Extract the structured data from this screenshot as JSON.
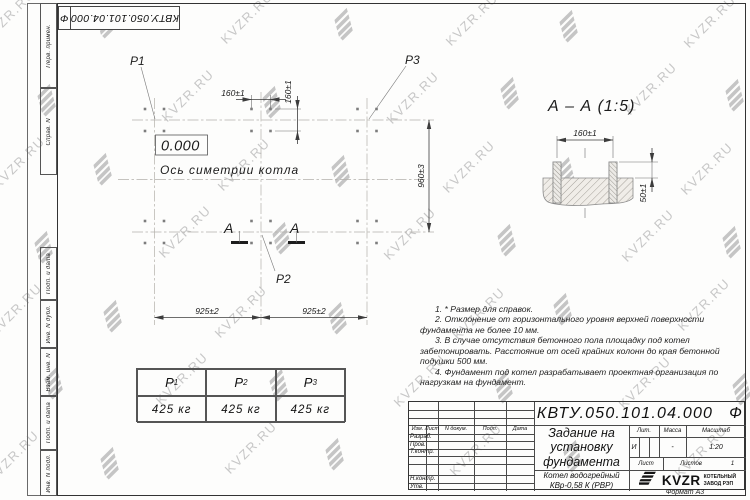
{
  "colors": {
    "ink": "#1c1c1c",
    "light_line": "#b3b0ab",
    "watermark": "#c7c7c7"
  },
  "watermark": {
    "text": "KVZR.RU"
  },
  "side_column": {
    "labels": [
      "Перв. примен.",
      "Справ. N",
      "Подп. и дата",
      "Инв. N дубл.",
      "Взам. инв. N",
      "Подп. и дата",
      "Инв. N подл."
    ]
  },
  "plan": {
    "markers": {
      "p1": "P1",
      "p2": "P2",
      "p3": "P3"
    },
    "elevation": "0.000",
    "axis_label": "Ось симетрии котла",
    "section_letter": "А",
    "dims": {
      "col_left": "925±2",
      "col_right": "925±2",
      "row": "960±3",
      "bolt_h": "160±1",
      "bolt_v": "160±1"
    }
  },
  "section": {
    "title": "А – А (1:5)",
    "dims": {
      "spacing": "160±1",
      "height": "50±1"
    }
  },
  "loads_table": {
    "headers": [
      {
        "base": "P",
        "sub": "1"
      },
      {
        "base": "P",
        "sub": "2"
      },
      {
        "base": "P",
        "sub": "3"
      }
    ],
    "values": [
      "425 кг",
      "425 кг",
      "425 кг"
    ]
  },
  "notes": {
    "items": [
      "1. * Размер для справок.",
      "2. Отклонение от горизонтального уровня верхней поверхности фундамента не более 10 мм.",
      "3. В случае отсутствия бетонного пола площадку под котел забетонировать. Расстояние от осей крайних колонн до края бетонной подушки 500 мм.",
      "4. Фундамент под котел разрабатывает проектная организация по нагрузкам на фундамент."
    ]
  },
  "title_block": {
    "designation": "КВТУ.050.101.04.000",
    "designation_suffix": "Ф",
    "doc_title": "Задание на установку фундамента",
    "product": "Котел водогрейный КВр-0,58 К (РВР)",
    "columns": {
      "izm": "Изм.",
      "list": "Лист",
      "doc": "N докум.",
      "podp": "Подп.",
      "data": "Дата"
    },
    "rows": {
      "razrab": "Разраб.",
      "prov": "Пров.",
      "tkontr": "Т.контр.",
      "nkontr": "Н.контр.",
      "utv": "Утв."
    },
    "lit_label": "Лит.",
    "lit_value": "И",
    "mass_label": "Масса",
    "mass_value": "-",
    "scale_label": "Масштаб",
    "scale_value": "1:20",
    "sheet_label": "Лист",
    "sheets_label": "Листов",
    "sheets_value": "1",
    "brand": "KVZR",
    "company_line1": "КОТЕЛЬНЫЙ",
    "company_line2": "ЗАВОД РЭП",
    "format": "Формат А3"
  }
}
